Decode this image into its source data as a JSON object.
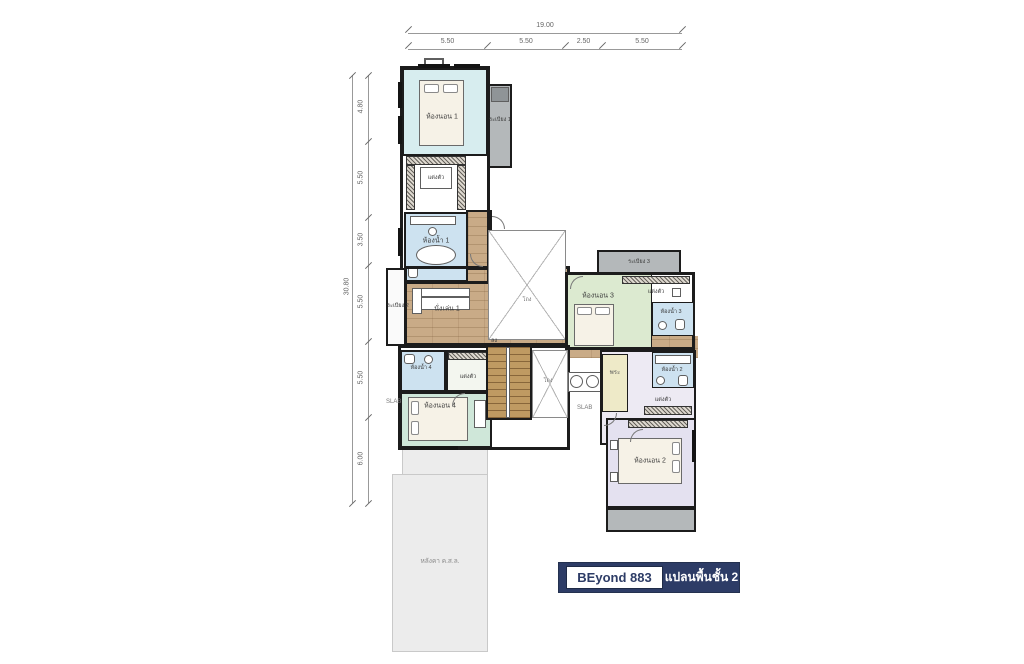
{
  "title_block": {
    "model": "BEyond 883",
    "plan_name": "แปลนพื้นชั้น 2"
  },
  "dimensions": {
    "top": {
      "total": "19.00",
      "segments": [
        "5.50",
        "5.50",
        "2.50",
        "5.50"
      ]
    },
    "left": {
      "total": "30.80",
      "segments": [
        "4.80",
        "5.50",
        "3.50",
        "5.50",
        "5.50",
        "6.00"
      ]
    }
  },
  "rooms": {
    "bedroom1": "ห้องนอน 1",
    "bedroom2": "ห้องนอน 2",
    "bedroom3": "ห้องนอน 3",
    "bedroom4": "ห้องนอน 4",
    "bathroom1": "ห้องน้ำ 1",
    "bathroom2": "ห้องน้ำ 2",
    "bathroom3": "ห้องน้ำ 3",
    "bathroom4": "ห้องน้ำ 4",
    "dressing1": "แต่งตัว",
    "dressing2": "แต่งตัว",
    "dressing3": "แต่งตัว",
    "dressing4": "แต่งตัว",
    "balcony1": "ระเบียง 1",
    "balcony2": "ระเบียง 2",
    "balcony3": "ระเบียง 3",
    "living1": "นั่งเล่น 1",
    "hall_void1": "โถง",
    "hall_void2": "โถง",
    "prayer": "พระ",
    "stairs_down": "ลง",
    "slab_left": "SLAB",
    "slab_center": "SLAB",
    "roof_slab": "หลังคา ค.ส.ล."
  },
  "colors": {
    "navy": "#2d3c66",
    "bedroom1_fill": "#d7edef",
    "bedroom2_fill": "#e4e1f0",
    "bedroom3_fill": "#dcead0",
    "bedroom4_fill": "#cfe7d9",
    "bathroom_fill": "#cde2f0",
    "prayer_fill": "#eeeac8",
    "balcony_fill": "#b4b8ba",
    "wood_fill": "#c9ab87",
    "roof_fill": "#ececec"
  }
}
